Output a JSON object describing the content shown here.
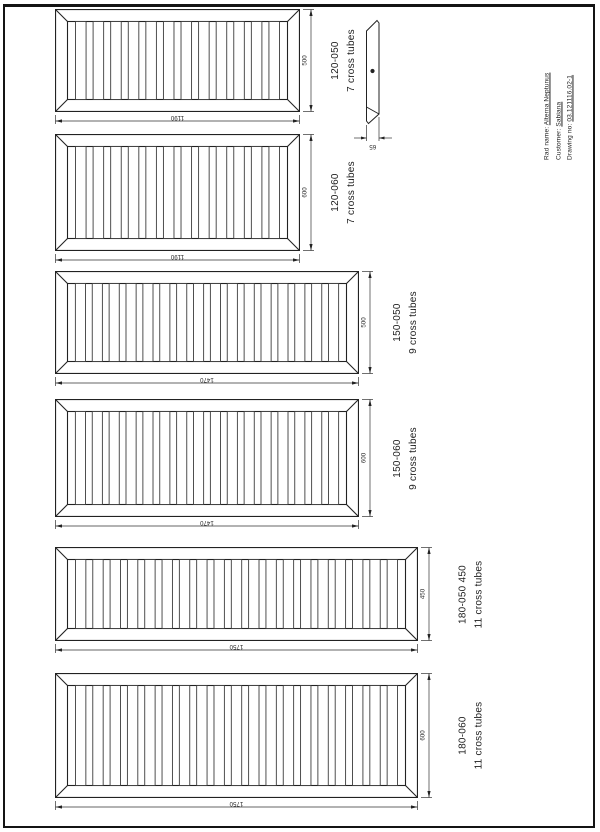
{
  "sheet": {
    "background": "#ffffff",
    "border_color": "#141414",
    "line_color": "#222222"
  },
  "title_block": {
    "rad_name_label": "Rad name:",
    "rad_name_value": "Alterna Neptunus",
    "customer_label": "Customer:",
    "customer_value": "Sabiana",
    "drawing_no_label": "Drawing no:",
    "drawing_no_value": "03.121116.02-1"
  },
  "profile_view": {
    "width_dim": "65"
  },
  "panels": [
    {
      "model": "120-050",
      "tubes_label": "7 cross tubes",
      "height_dim": "500",
      "length_dim": "1190",
      "tube_count": 12
    },
    {
      "model": "120-060",
      "tubes_label": "7 cross tubes",
      "height_dim": "600",
      "length_dim": "1190",
      "tube_count": 12
    },
    {
      "model": "150-050",
      "tubes_label": "9 cross tubes",
      "height_dim": "500",
      "length_dim": "1470",
      "tube_count": 16
    },
    {
      "model": "150-060",
      "tubes_label": "9 cross tubes",
      "height_dim": "600",
      "length_dim": "1470",
      "tube_count": 16
    },
    {
      "model": "180-050 450",
      "tubes_label": "11 cross tubes",
      "height_dim": "450",
      "length_dim": "1750",
      "tube_count": 19
    },
    {
      "model": "180-060",
      "tubes_label": "11 cross tubes",
      "height_dim": "600",
      "length_dim": "1750",
      "tube_count": 19
    }
  ]
}
